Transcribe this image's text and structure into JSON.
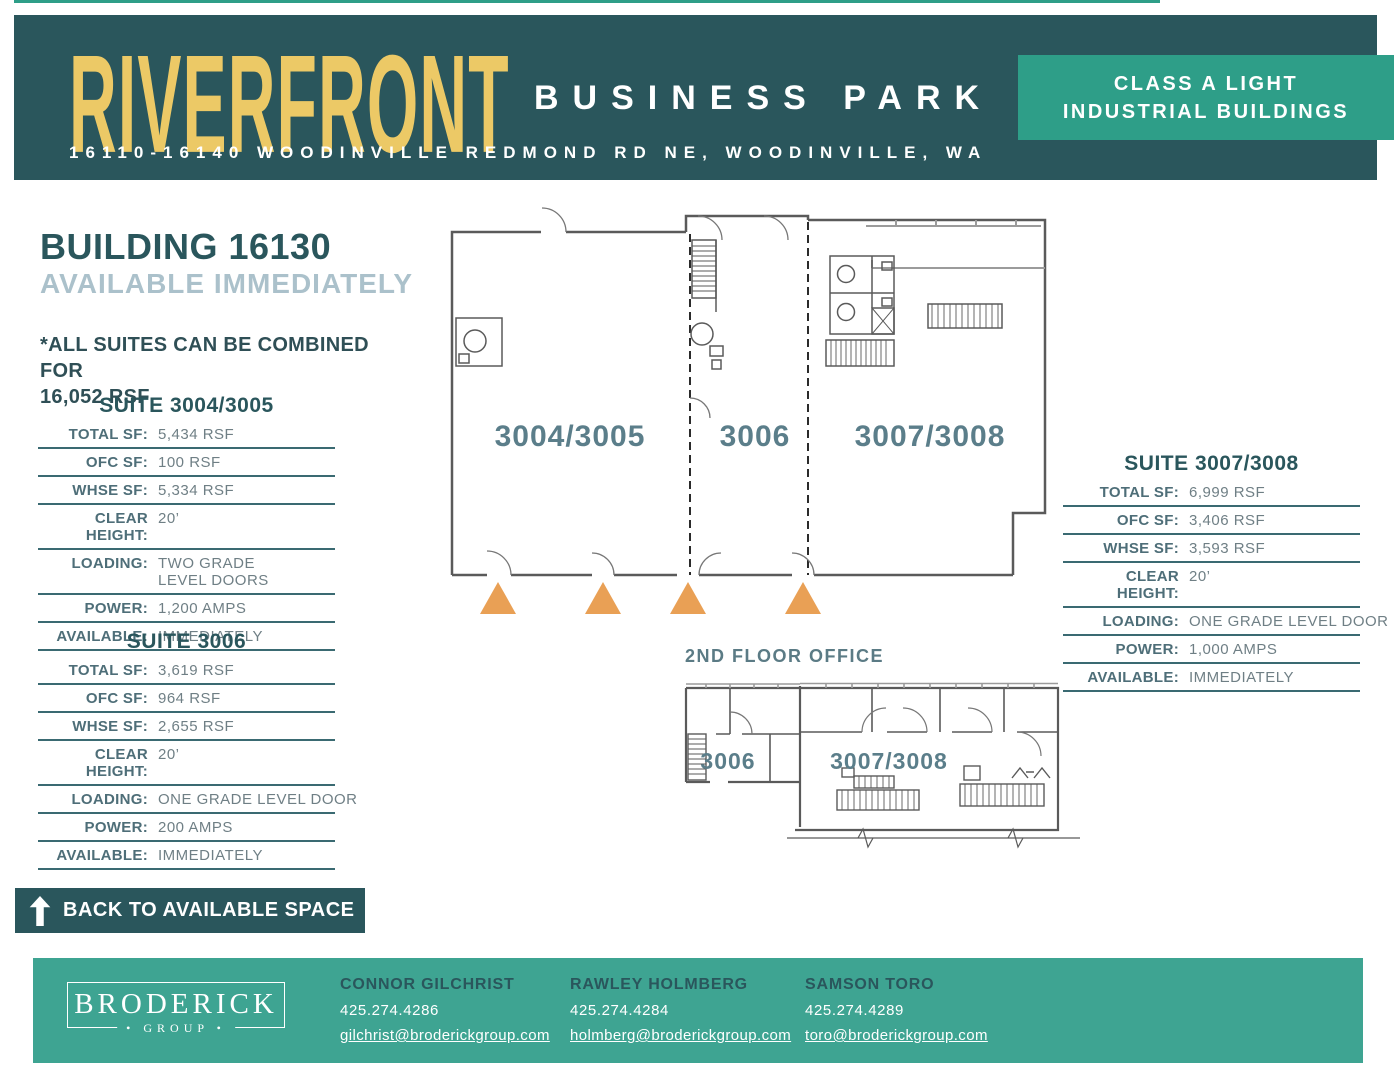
{
  "colors": {
    "dark_teal": "#2A565C",
    "accent_teal": "#2E9E88",
    "footer_teal": "#3EA492",
    "gold": "#ECC966",
    "marker_orange": "#E9A055",
    "light_slate": "#ABC1CB",
    "table_rule": "#3A6A72",
    "plan_label": "#5B7E8A"
  },
  "header": {
    "title": "RIVERFRONT",
    "subtitle": "BUSINESS PARK",
    "address": "16110-16140 WOODINVILLE REDMOND RD NE, WOODINVILLE, WA",
    "badge": {
      "line1": "CLASS A LIGHT",
      "line2": "INDUSTRIAL BUILDINGS"
    }
  },
  "building": {
    "title": "BUILDING 16130",
    "availability": "AVAILABLE IMMEDIATELY",
    "combine_note_line1": "*ALL SUITES CAN BE COMBINED FOR",
    "combine_note_line2": "16,052 RSF"
  },
  "suite_3004_3005": {
    "title": "SUITE 3004/3005",
    "rows": [
      {
        "label": "TOTAL SF:",
        "value": "5,434 RSF"
      },
      {
        "label": "OFC SF:",
        "value": "100 RSF"
      },
      {
        "label": "WHSE SF:",
        "value": "5,334 RSF"
      },
      {
        "label": "CLEAR HEIGHT:",
        "value": "20’"
      },
      {
        "label": "LOADING:",
        "value": "TWO GRADE LEVEL DOORS"
      },
      {
        "label": "POWER:",
        "value": "1,200 AMPS"
      },
      {
        "label": "AVAILABLE:",
        "value": "IMMEDIATELY"
      }
    ]
  },
  "suite_3006": {
    "title": "SUITE 3006",
    "rows": [
      {
        "label": "TOTAL SF:",
        "value": "3,619 RSF"
      },
      {
        "label": "OFC SF:",
        "value": "964 RSF"
      },
      {
        "label": "WHSE SF:",
        "value": "2,655 RSF"
      },
      {
        "label": "CLEAR HEIGHT:",
        "value": "20’"
      },
      {
        "label": "LOADING:",
        "value": "ONE GRADE LEVEL DOOR"
      },
      {
        "label": "POWER:",
        "value": "200 AMPS"
      },
      {
        "label": "AVAILABLE:",
        "value": "IMMEDIATELY"
      }
    ]
  },
  "suite_3007_3008": {
    "title": "SUITE 3007/3008",
    "rows": [
      {
        "label": "TOTAL SF:",
        "value": "6,999 RSF"
      },
      {
        "label": "OFC SF:",
        "value": "3,406 RSF"
      },
      {
        "label": "WHSE SF:",
        "value": "3,593 RSF"
      },
      {
        "label": "CLEAR HEIGHT:",
        "value": "20’"
      },
      {
        "label": "LOADING:",
        "value": "ONE GRADE LEVEL DOOR"
      },
      {
        "label": "POWER:",
        "value": "1,000 AMPS"
      },
      {
        "label": "AVAILABLE:",
        "value": "IMMEDIATELY"
      }
    ]
  },
  "floorplan": {
    "labels": {
      "left": "3004/3005",
      "middle": "3006",
      "right": "3007/3008"
    },
    "grade_door_marker_count": 4
  },
  "second_floor": {
    "title": "2ND FLOOR OFFICE",
    "labels": {
      "left": "3006",
      "right": "3007/3008"
    }
  },
  "back_button": {
    "label": "BACK TO AVAILABLE SPACE"
  },
  "footer": {
    "logo": {
      "name": "BRODERICK",
      "sub": "• GROUP •"
    },
    "contacts": [
      {
        "name": "CONNOR GILCHRIST",
        "phone": "425.274.4286",
        "email": "gilchrist@broderickgroup.com"
      },
      {
        "name": "RAWLEY HOLMBERG",
        "phone": "425.274.4284",
        "email": "holmberg@broderickgroup.com"
      },
      {
        "name": "SAMSON TORO",
        "phone": "425.274.4289",
        "email": "toro@broderickgroup.com"
      }
    ]
  }
}
